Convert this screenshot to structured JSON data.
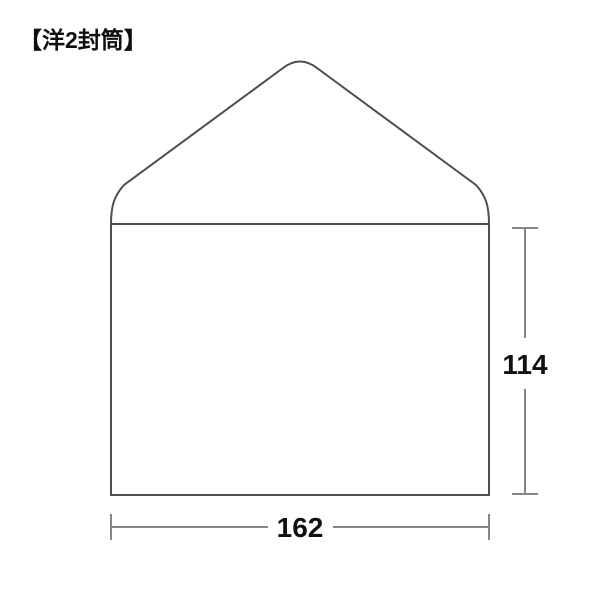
{
  "page": {
    "background_color": "#ffffff",
    "title": "【洋2封筒】"
  },
  "diagram": {
    "subject": "yo2-envelope",
    "outline_color": "#4d4d4d",
    "dimension_line_color": "#858585",
    "label_color": "#111111",
    "dimensions": {
      "height_label": "114",
      "width_label": "162"
    }
  }
}
